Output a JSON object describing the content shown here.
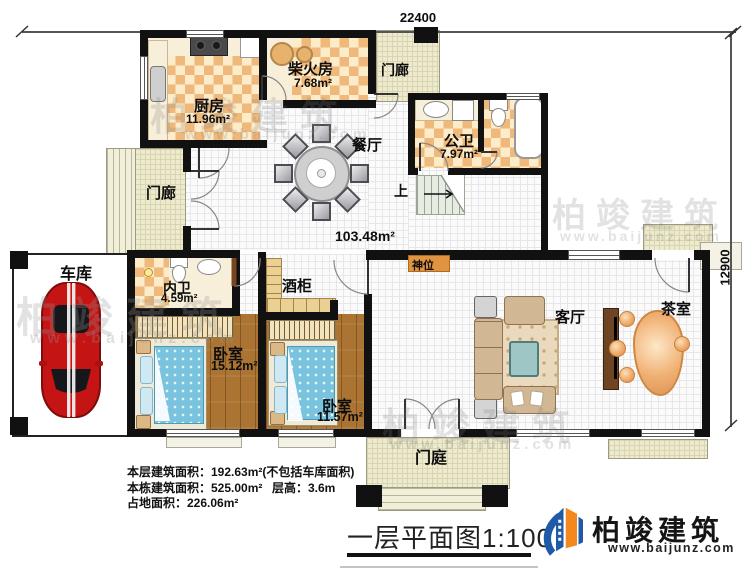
{
  "dimensions": {
    "width_label": "22400",
    "height_label": "12900"
  },
  "watermark": {
    "brand": "柏竣建筑",
    "url": "www.baijunz.com"
  },
  "rooms": {
    "firewood": {
      "name": "柴火房",
      "area": "7.68m²"
    },
    "kitchen": {
      "name": "厨房",
      "area": "11.96m²"
    },
    "porch_top": {
      "name": "门廊"
    },
    "porch_left": {
      "name": "门廊"
    },
    "public_bath": {
      "name": "公卫",
      "area": "7.97m²"
    },
    "dining": {
      "name": "餐厅"
    },
    "stair": {
      "name": "上"
    },
    "hall": {
      "area": "103.48m²"
    },
    "shrine": {
      "name": "神位"
    },
    "garage": {
      "name": "车库"
    },
    "inner_bath": {
      "name": "内卫",
      "area": "4.59m²"
    },
    "wine_cabinet": {
      "name": "酒柜"
    },
    "bedroom_a": {
      "name": "卧室",
      "area": "15.12m²"
    },
    "bedroom_b": {
      "name": "卧室",
      "area": "11.57m²"
    },
    "living": {
      "name": "客厅"
    },
    "tea": {
      "name": "茶室"
    },
    "entry": {
      "name": "门庭"
    }
  },
  "stats": {
    "line1": "本层建筑面积：192.63m²(不包括车库面积)",
    "line2a": "本栋建筑面积：525.00m²",
    "line2b": "层高：3.6m",
    "line3": "占地面积：226.06m²"
  },
  "footer": {
    "title": "一层平面图1:100",
    "brand": "柏竣建筑",
    "brand_url": "www.baijunz.com"
  },
  "colors": {
    "wall": "#111111",
    "checker": "#efb97b",
    "wood": "#ab7433",
    "porch": "#edeacd",
    "car_red": "#c41414",
    "bed_blue": "#79c3de",
    "sofa_tan": "#d2b794",
    "tea_orange": "#eda763",
    "brand_blue": "#1e5aa8",
    "brand_orange": "#f5871f"
  }
}
